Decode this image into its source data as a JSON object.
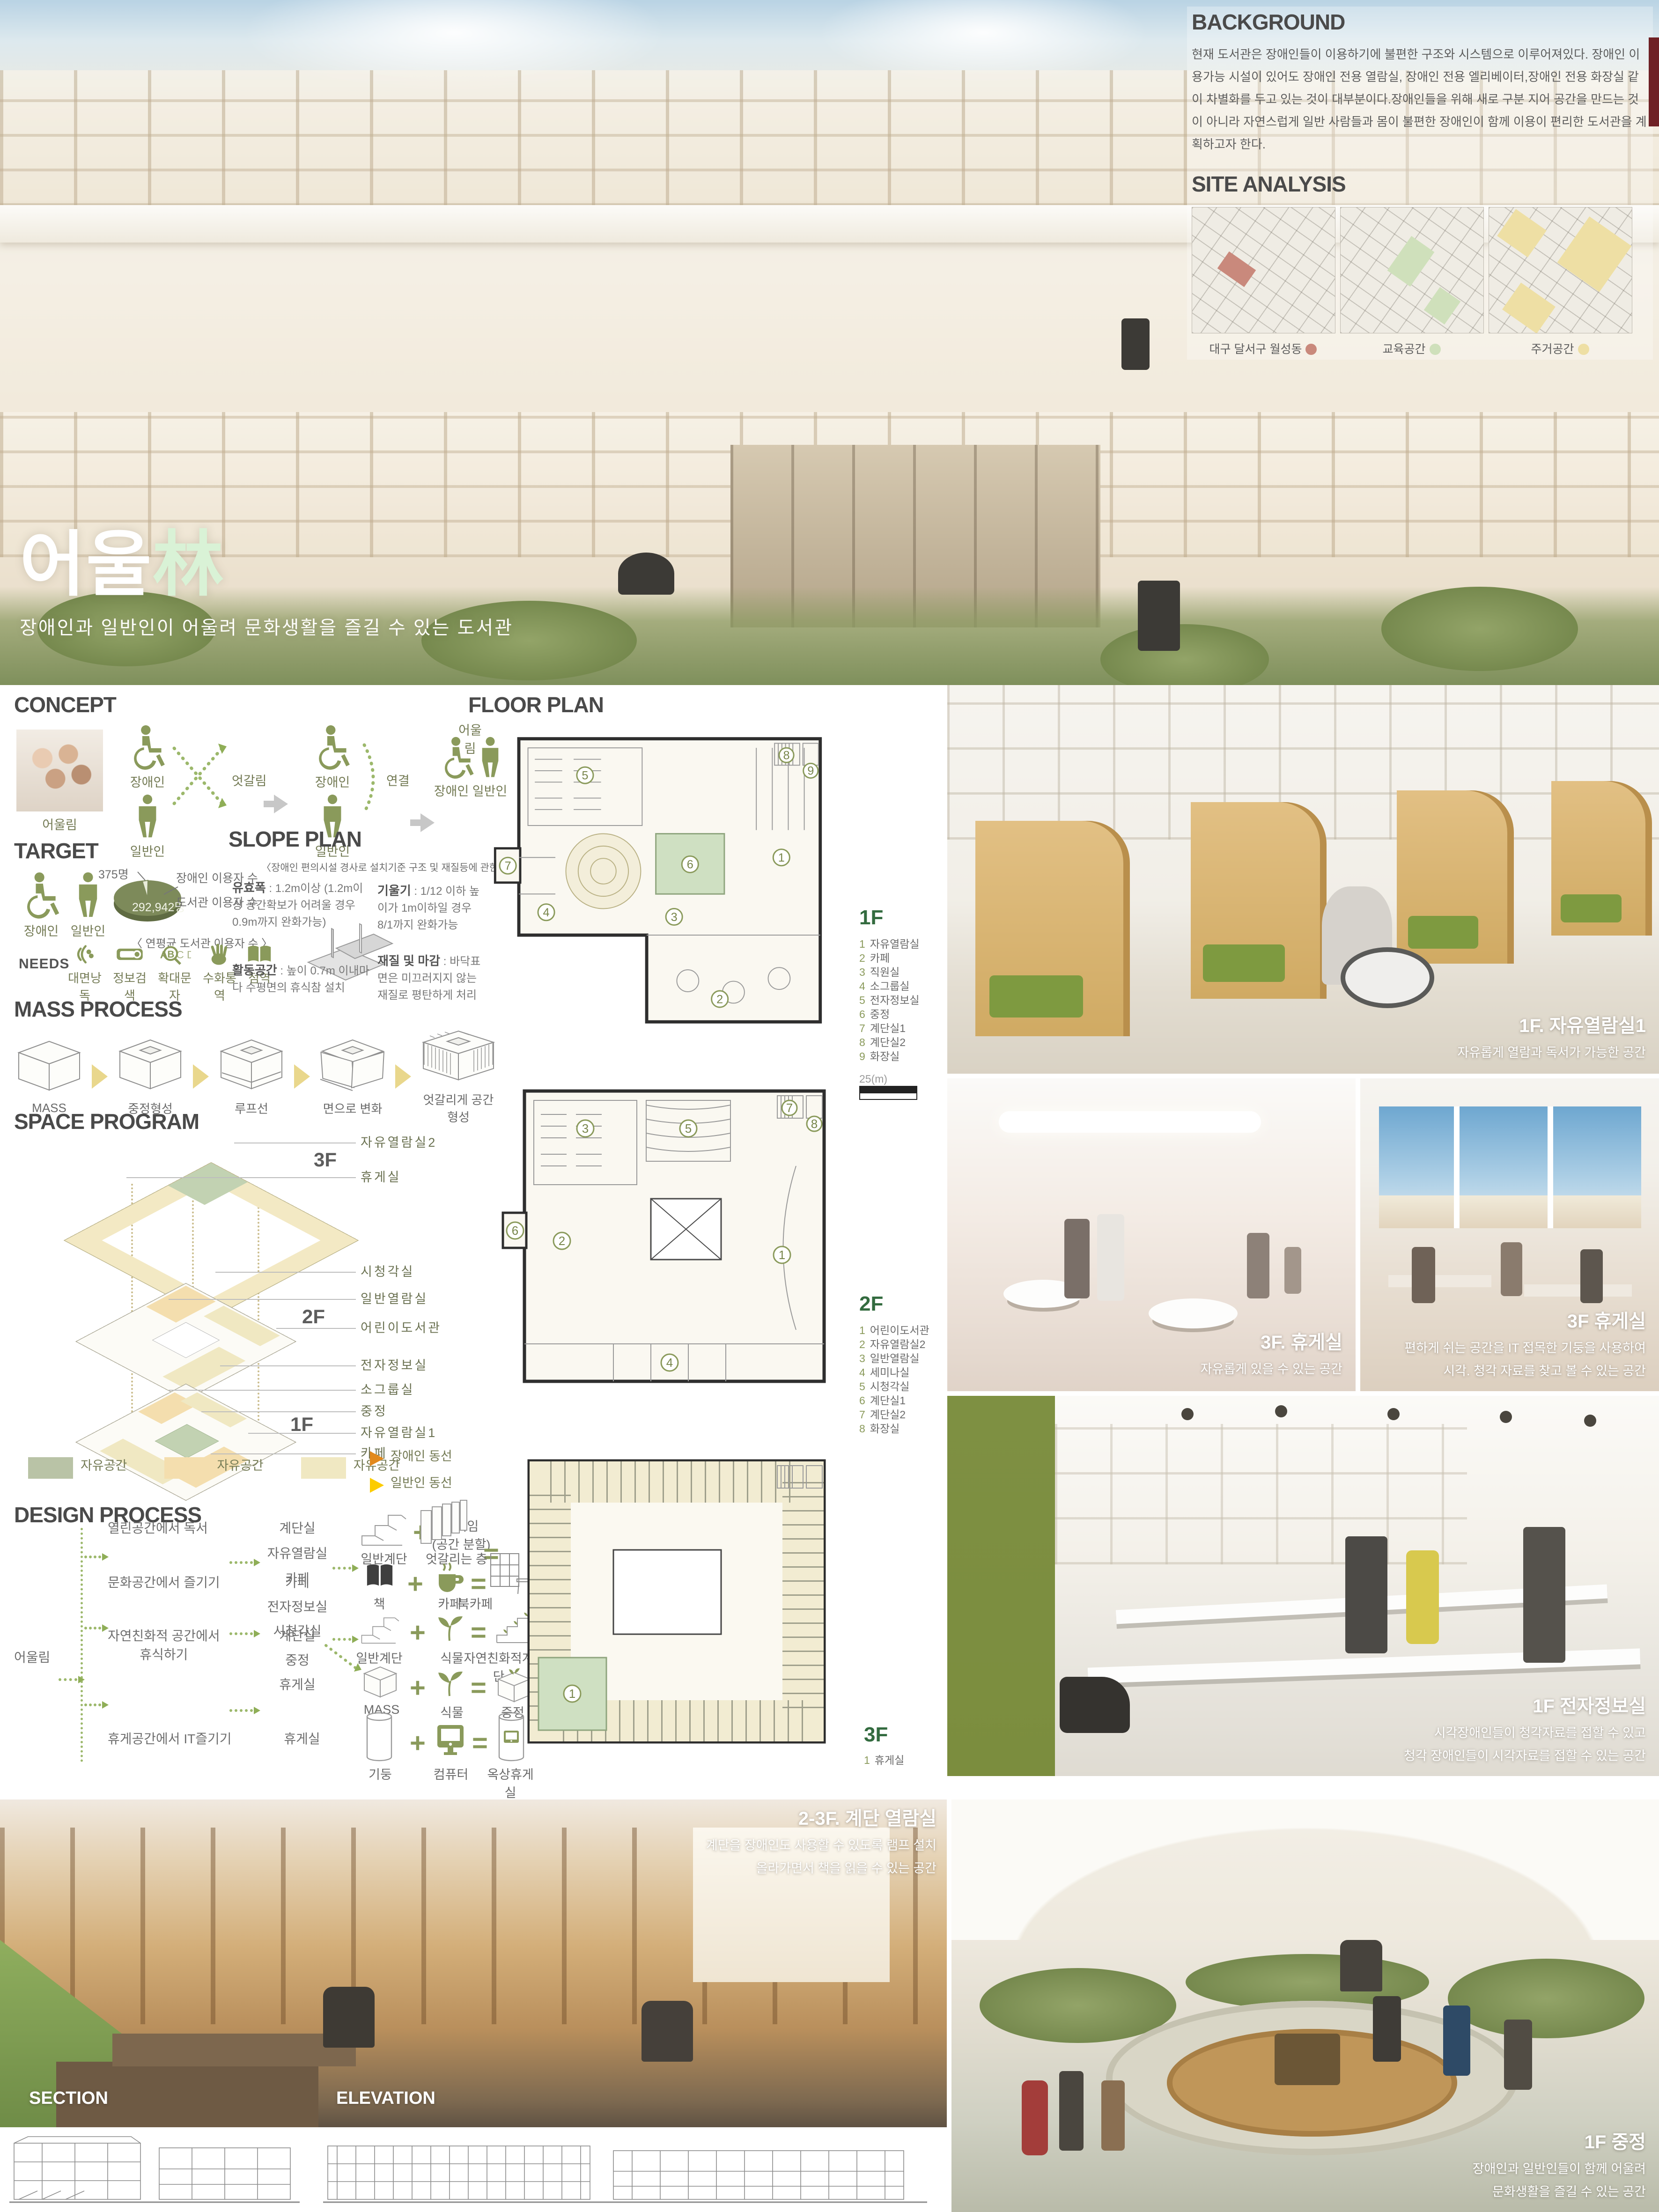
{
  "hero": {
    "title_kr": "어울",
    "title_hanja": "林",
    "subtitle": "장애인과 일반인이 어울려 문화생활을 즐길 수 있는 도서관"
  },
  "background": {
    "heading": "BACKGROUND",
    "body": "현재 도서관은 장애인들이 이용하기에 불편한 구조와 시스템으로 이루어져있다. 장애인 이용가능 시설이 있어도 장애인 전용 열람실, 장애인 전용 엘리베이터,장애인 전용 화장실 같이 차별화를 두고 있는 것이 대부분이다.장애인들을 위해 새로 구분 지어 공간을 만드는 것이 아니라 자연스럽게 일반 사람들과 몸이 불편한 장애인이 함께 이용이 편리한 도서관을 계획하고자 한다."
  },
  "site_analysis": {
    "heading": "SITE ANALYSIS",
    "maps": [
      {
        "caption": "대구 달서구 월성동",
        "dot_color": "#c9897c"
      },
      {
        "caption": "교육공간",
        "dot_color": "#cfe0bb"
      },
      {
        "caption": "주거공간",
        "dot_color": "#eedfa4"
      }
    ]
  },
  "concept": {
    "heading": "CONCEPT",
    "photo_caption": "어울림",
    "disabled": "장애인",
    "general": "일반인",
    "cross": "엇갈림",
    "connect": "연결",
    "merge": "어울림",
    "pair": "장애인  일반인"
  },
  "target": {
    "heading": "TARGET",
    "disabled": "장애인",
    "general": "일반인",
    "pie": {
      "small_value": "375명",
      "small_label": "장애인 이용자 수",
      "big_value": "292,942명",
      "big_label": "도서관 이용자 수",
      "caption": "〈 연평균 도서관  이용자 수 〉",
      "color": "#7d8a5a"
    },
    "needs_label": "NEEDS",
    "needs": [
      "대면낭독",
      "정보검색",
      "확대문자",
      "수화통역",
      "점역"
    ]
  },
  "slope_plan": {
    "heading": "SLOPE PLAN",
    "note": "〈장애인  편의시설 경사로 설치기준 구조 및 재질등에 관한 세부사항〉",
    "specs": [
      {
        "term": "유효폭",
        "desc": " : 1.2m이상 (1.2m이상 공간확보가 어려울 경우 0.9m까지 완화가능)"
      },
      {
        "term": "기울기",
        "desc": " : 1/12 이하 높이가 1m이하일 경우 8/1까지 완화가능"
      },
      {
        "term": "활동공간",
        "desc": " : 높이 0.7m 이내마다 수평면의 휴식참 설치"
      },
      {
        "term": "재질 및 마감",
        "desc": " : 바닥표면은 미끄러지지 않는 재질로 평탄하게 처리"
      }
    ]
  },
  "mass_process": {
    "heading": "MASS PROCESS",
    "steps": [
      "MASS",
      "중정형성",
      "루프선",
      "면으로 변화",
      "엇갈리게 공간 형성"
    ]
  },
  "space_program": {
    "heading": "SPACE PROGRAM",
    "tags": {
      "f3": "3F",
      "f2": "2F",
      "f1": "1F"
    },
    "labels3": [
      "자유열람실2",
      "휴게실"
    ],
    "labels2": [
      "시청각실",
      "일반열람실",
      "어린이도서관"
    ],
    "labels1": [
      "전자정보실",
      "소그룹실",
      "중정",
      "자유열람실1",
      "카페"
    ],
    "legend": [
      {
        "label": "자유공간",
        "color": "#b9c3a6"
      },
      {
        "label": "자유공간",
        "color": "#f4deae"
      },
      {
        "label": "자유공간",
        "color": "#f0e8c2"
      }
    ],
    "flows": [
      {
        "label": "장애인 동선",
        "color": "#e2891d"
      },
      {
        "label": "일반인 동선",
        "color": "#fccc00"
      }
    ]
  },
  "design_process": {
    "heading": "DESIGN PROCESS",
    "root": "어울림",
    "rows": [
      {
        "activity": "열린공간에서 독서",
        "spaces": [
          "계단실",
          "자유열람실",
          "카페"
        ]
      },
      {
        "activity": "문화공간에서 즐기기",
        "spaces": [
          "카페",
          "전자정보실",
          "시청각실"
        ]
      },
      {
        "activity": "자연친화적 공간에서",
        "activity2": "휴식하기",
        "spaces": [
          "계단실",
          "중정",
          "휴게실"
        ]
      },
      {
        "activity": "휴게공간에서 IT즐기기",
        "spaces": [
          "휴게실"
        ]
      }
    ],
    "formulas": [
      {
        "a": "일반계단",
        "b1": "움직임",
        "b2": "(공간 분할)",
        "result": "엇갈리는 층"
      },
      {
        "a": "책",
        "b1": "카페",
        "result": "북카페"
      },
      {
        "a": "일반계단",
        "b1": "식물",
        "result": "자연친화적계단"
      },
      {
        "a": "MASS",
        "b1": "식물",
        "result": "중정"
      },
      {
        "a": "기둥",
        "b1": "컴퓨터",
        "result": "옥상휴게실"
      }
    ]
  },
  "ops": {
    "plus": "+",
    "equals": "="
  },
  "floor_plan": {
    "heading": "FLOOR PLAN",
    "numbers": [
      "1",
      "2",
      "3",
      "4",
      "5",
      "6",
      "7",
      "8",
      "9"
    ],
    "scale_label": "25(m)",
    "floor1": {
      "tag": "1F",
      "legend": [
        {
          "n": "1",
          "t": "자유열람실"
        },
        {
          "n": "2",
          "t": "카페"
        },
        {
          "n": "3",
          "t": "직원실"
        },
        {
          "n": "4",
          "t": "소그룹실"
        },
        {
          "n": "5",
          "t": "전자정보실"
        },
        {
          "n": "6",
          "t": "중정"
        },
        {
          "n": "7",
          "t": "계단실1"
        },
        {
          "n": "8",
          "t": "계단실2"
        },
        {
          "n": "9",
          "t": "화장실"
        }
      ]
    },
    "floor2": {
      "tag": "2F",
      "legend": [
        {
          "n": "1",
          "t": "어린이도서관"
        },
        {
          "n": "2",
          "t": "자유열람실2"
        },
        {
          "n": "3",
          "t": "일반열람실"
        },
        {
          "n": "4",
          "t": "세미나실"
        },
        {
          "n": "5",
          "t": "시청각실"
        },
        {
          "n": "6",
          "t": "계단실1"
        },
        {
          "n": "7",
          "t": "계단실2"
        },
        {
          "n": "8",
          "t": "화장실"
        }
      ]
    },
    "floor3": {
      "tag": "3F",
      "legend": [
        {
          "n": "1",
          "t": "휴게실"
        }
      ]
    }
  },
  "renders": {
    "reading1": {
      "title": "1F. 자유열람실1",
      "line1": "자유롭게 열람과 독서가 가능한 공간"
    },
    "lounge_a": {
      "title": "3F. 휴게실",
      "line1": "자유롭게 있을 수 있는 공간"
    },
    "lounge_b": {
      "title": "3F 휴게실",
      "line1": "편하게 쉬는 공간을 IT 접목한 기둥을 사용하여",
      "line2": "시각. 청각 자료를 찾고 볼 수 있는 공간"
    },
    "digital": {
      "title": "1F 전자정보실",
      "line1": "시각장애인들이 청각자료를 접할 수 있고",
      "line2": "청각 장애인들이 시각자료를 접할 수 있는 공간"
    },
    "stair": {
      "title": "2-3F. 계단 열람실",
      "line1": "계단을 장애인도 사용할 수 있도록 램프 설치",
      "line2": "올라가면서 책을 읽을 수 있는 공간"
    },
    "courtyard": {
      "title": "1F 중정",
      "line1": "장애인과 일반인들이 함께 어울려",
      "line2": "문화생활을 즐길 수 있는 공간"
    }
  },
  "drawings": {
    "section": "SECTION",
    "elevation": "ELEVATION"
  }
}
